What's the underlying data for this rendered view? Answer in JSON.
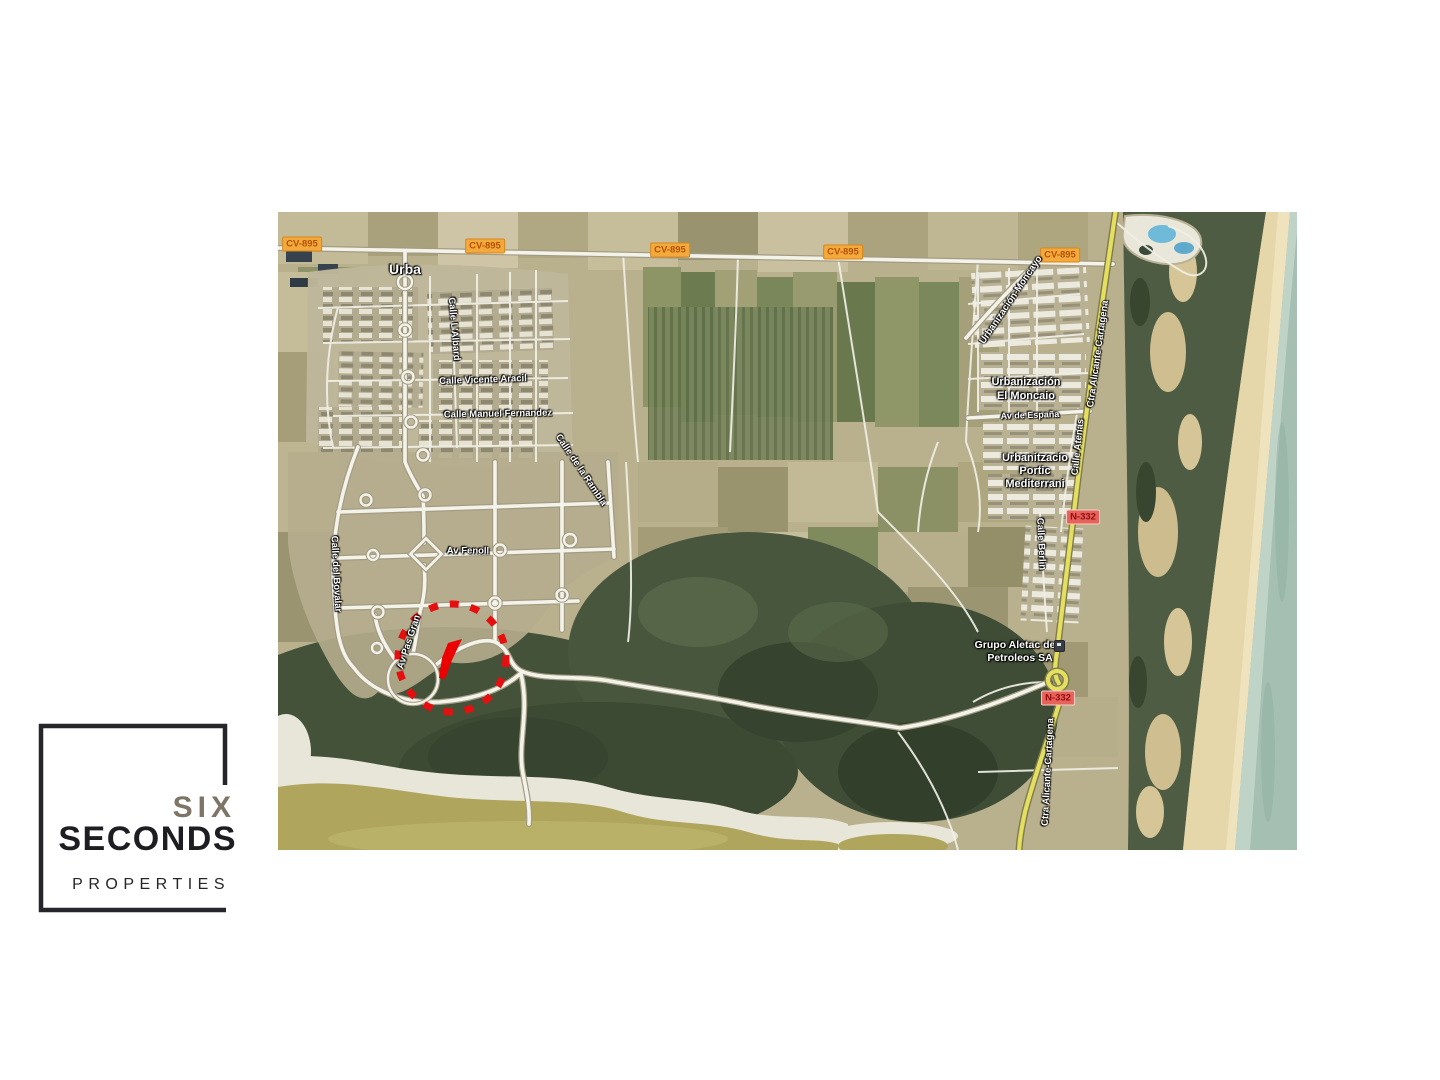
{
  "logo": {
    "six": "SIX",
    "seconds": "SECONDS",
    "properties": "PROPERTIES"
  },
  "map": {
    "badges": {
      "cv895": "CV-895",
      "n332": "N-332"
    },
    "streets": {
      "urba": "Urba",
      "albard": "Calle L'Albard",
      "vicente_aracil": "Calle Vicente Aracil",
      "manuel_fernandez": "Calle Manuel Fernandez",
      "bovalar": "Calle del Bovalar",
      "rambla": "Calle de la Rambla",
      "av_fenoll": "Av Fenoll",
      "av_pas_gran": "Av Pas Gran",
      "urbanizacion_moncayo": "Urbanización-Moncayo",
      "av_espana": "Av de España",
      "ctra_alicante_cartagena": "Ctra Alicante-Cartagena",
      "calle_atenas": "Calle Atenas",
      "calle_berlin": "Calle Berlin"
    },
    "places": {
      "el_moncaio_1": "Urbanización",
      "el_moncaio_2": "El Moncaio",
      "portic_1": "Urbanitzacio",
      "portic_2": "Portic",
      "portic_3": "Mediterrani",
      "grupo_1": "Grupo Aletac de",
      "grupo_2": "Petroleos SA"
    },
    "colors": {
      "cv_badge_bg": "#F4A93C",
      "cv_badge_text": "#B35309",
      "n_badge_bg": "#E8625C",
      "n_badge_text": "#8F0D0D",
      "marker_red": "#EC0000",
      "national_road": "#E5DE61",
      "sea": "#A5C0B3",
      "marsh": "#44523A",
      "lagoon": "#AFA55D",
      "logo_taupe": "#7D7566",
      "logo_black": "#1E1E22"
    }
  }
}
